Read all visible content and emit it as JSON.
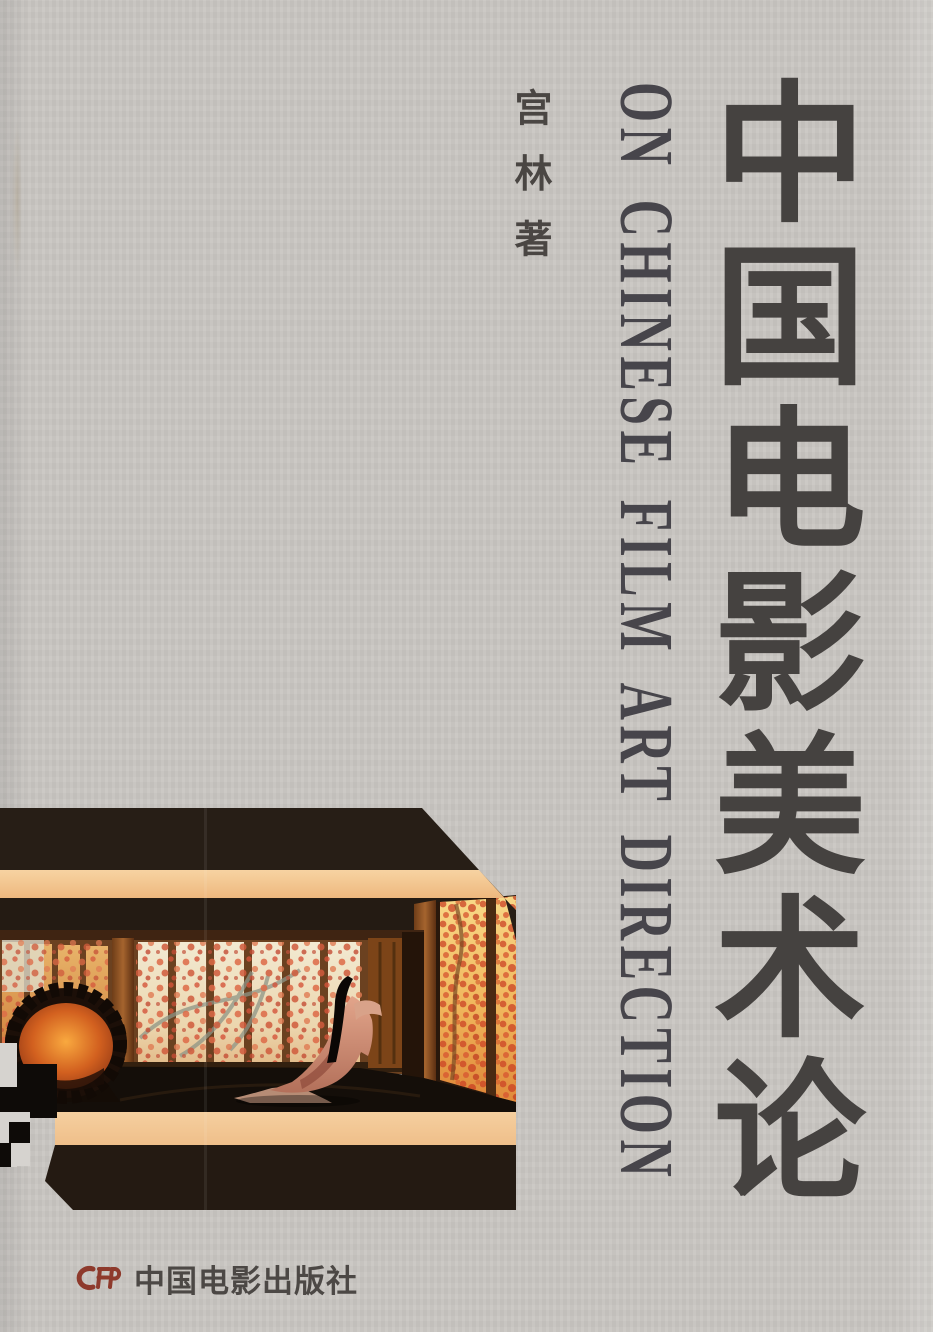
{
  "cover": {
    "author_line": "宫 林 著",
    "title_cn": "中国电影美术论",
    "title_en": "ON CHINESE FILM ART DIRECTION",
    "publisher": {
      "logo_text": "CFP",
      "name": "中国电影出版社"
    },
    "film_still": {
      "alt": "Film still: dim palace interior, rows of backlit screens painted with red plum blossoms, an ornate glowing mirror at left and a long-haired woman in a flowing robe opening a wooden door at right"
    },
    "colors": {
      "background": "#c9c6c2",
      "title_text": "#454240",
      "english_title_text": "#47454b",
      "logo_red": "#8e3a2c",
      "still_dark_band": "#261d15",
      "still_peach_band": "#f3c795",
      "still_glow_orange": "#e8943e",
      "still_blossom_red": "#cc4526"
    }
  }
}
